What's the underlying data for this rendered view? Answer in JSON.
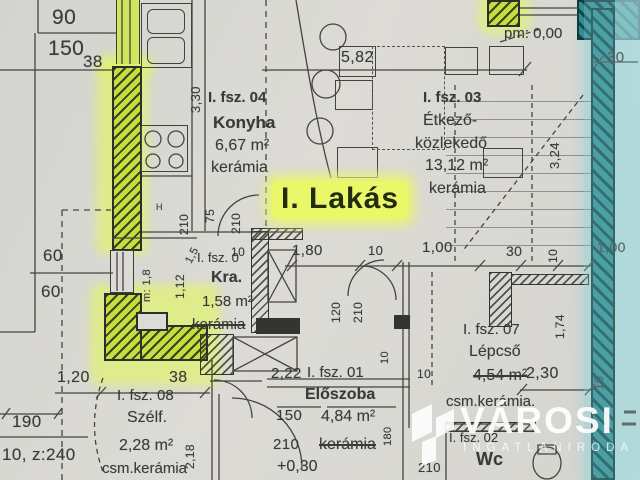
{
  "plan_highlight": {
    "label": "I. Lakás"
  },
  "annotations": {
    "level_mark": "pm: 0,00",
    "fixture_h": "H"
  },
  "rooms": {
    "konyha": {
      "id": "I. fsz. 04",
      "name": "Konyha",
      "area": "6,67 m²",
      "floor": "kerámia"
    },
    "etkezo": {
      "id": "I. fsz. 03",
      "name_line1": "Étkező-",
      "name_line2": "közlekedő",
      "area": "13,12 m²",
      "floor": "kerámia"
    },
    "kamra": {
      "id": "I. fsz. 0",
      "name": "Kra.",
      "area": "1,58 m²",
      "floor": "kerámia"
    },
    "lepcso": {
      "id": "I. fsz. 07",
      "name": "Lépcső",
      "area": "4,54 m²",
      "floor": "csm.kerámia."
    },
    "szelfogo": {
      "id": "I. fsz. 08",
      "name": "Szélf.",
      "area": "2,28 m²",
      "floor": "csm.kerámia"
    },
    "eloszoba": {
      "id": "I. fsz. 01",
      "name": "Előszoba",
      "area": "4,84 m²",
      "floor": "kerámia",
      "level": "+0,30"
    },
    "wc": {
      "id": "I. fsz. 02",
      "name": "Wc"
    }
  },
  "dimensions": [
    {
      "t": "90",
      "x": 52,
      "y": 6,
      "s": 21
    },
    {
      "t": "150",
      "x": 48,
      "y": 37,
      "s": 21
    },
    {
      "t": "38",
      "x": 83,
      "y": 52,
      "s": 17
    },
    {
      "t": "3,30",
      "x": 188,
      "y": 113,
      "s": 13,
      "r": -90
    },
    {
      "t": "5,82",
      "x": 341,
      "y": 49,
      "s": 16
    },
    {
      "t": "30",
      "x": 607,
      "y": 49,
      "s": 15
    },
    {
      "t": "3,24",
      "x": 547,
      "y": 169,
      "s": 13,
      "r": -90
    },
    {
      "t": "210",
      "x": 177,
      "y": 235,
      "s": 12,
      "r": -90
    },
    {
      "t": "75",
      "x": 203,
      "y": 223,
      "s": 12,
      "r": -90
    },
    {
      "t": "210",
      "x": 229,
      "y": 234,
      "s": 12,
      "r": -90
    },
    {
      "t": "60",
      "x": 43,
      "y": 246,
      "s": 17
    },
    {
      "t": "60",
      "x": 41,
      "y": 282,
      "s": 17
    },
    {
      "t": "m: 1,8",
      "x": 141,
      "y": 302,
      "s": 11,
      "r": -90
    },
    {
      "t": "1,12",
      "x": 173,
      "y": 299,
      "s": 12,
      "r": -90
    },
    {
      "t": "1,5",
      "x": 183,
      "y": 260,
      "s": 11,
      "r": -62
    },
    {
      "t": "10",
      "x": 231,
      "y": 245,
      "s": 12
    },
    {
      "t": "1,80",
      "x": 292,
      "y": 242,
      "s": 15
    },
    {
      "t": "10",
      "x": 368,
      "y": 243,
      "s": 13
    },
    {
      "t": "1,00",
      "x": 422,
      "y": 239,
      "s": 15
    },
    {
      "t": "30",
      "x": 506,
      "y": 243,
      "s": 14
    },
    {
      "t": "10",
      "x": 546,
      "y": 263,
      "s": 12,
      "r": -90
    },
    {
      "t": "1,00",
      "x": 597,
      "y": 239,
      "s": 14
    },
    {
      "t": "120",
      "x": 329,
      "y": 323,
      "s": 12,
      "r": -90
    },
    {
      "t": "210",
      "x": 351,
      "y": 323,
      "s": 12,
      "r": -90
    },
    {
      "t": "1,74",
      "x": 553,
      "y": 339,
      "s": 12,
      "r": -90
    },
    {
      "t": "10",
      "x": 379,
      "y": 364,
      "s": 11,
      "r": -90
    },
    {
      "t": "1,20",
      "x": 57,
      "y": 369,
      "s": 16
    },
    {
      "t": "38",
      "x": 169,
      "y": 369,
      "s": 16
    },
    {
      "t": "2,22",
      "x": 271,
      "y": 365,
      "s": 15
    },
    {
      "t": "10",
      "x": 417,
      "y": 367,
      "s": 12
    },
    {
      "t": "2,30",
      "x": 526,
      "y": 365,
      "s": 16
    },
    {
      "t": "10",
      "x": 592,
      "y": 390,
      "s": 12,
      "r": -90
    },
    {
      "t": "190",
      "x": 12,
      "y": 412,
      "s": 17
    },
    {
      "t": "150",
      "x": 276,
      "y": 407,
      "s": 15
    },
    {
      "t": "180",
      "x": 382,
      "y": 446,
      "s": 11,
      "r": -90
    },
    {
      "t": "210",
      "x": 273,
      "y": 436,
      "s": 15
    },
    {
      "t": "10, z:240",
      "x": 2,
      "y": 445,
      "s": 17
    },
    {
      "t": "2,18",
      "x": 183,
      "y": 469,
      "s": 12,
      "r": -90
    },
    {
      "t": "210",
      "x": 418,
      "y": 460,
      "s": 13
    }
  ],
  "watermark": {
    "brand": "VÁROSI",
    "subtitle": "INGATLANIRODA"
  },
  "colors": {
    "paper": "#d8d7d2",
    "ink": "#3c3c3c",
    "wall_green": "#c6dd3f",
    "glow_green": "#e7fa6a",
    "wall_teal": "#2f8d93",
    "glow_cyan": "#a9dadd",
    "highlight": "#e9f768",
    "watermark": "#ffffff"
  }
}
